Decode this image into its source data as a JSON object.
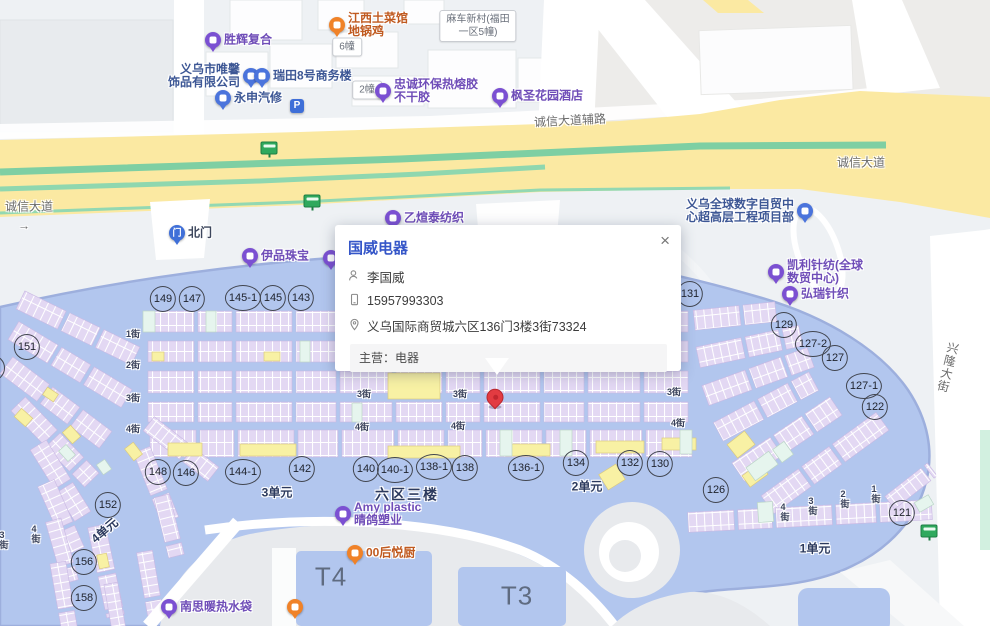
{
  "popup": {
    "title": "国威电器",
    "close": "×",
    "contact_name": "李国威",
    "phone": "15957993303",
    "address": "义乌国际商贸城六区136门3楼3街73324",
    "business_label": "主营：电器"
  },
  "map": {
    "marker": {
      "x": 495,
      "y": 399
    },
    "icons": {
      "gate_glyph": "门",
      "parking_glyph": "P",
      "bus_icon": "bus-stop-sign",
      "person_icon": "person-outline",
      "phone_icon": "mobile-phone-outline",
      "location_icon": "map-pin-outline",
      "close_icon": "x-close"
    },
    "colors": {
      "pin": {
        "purple": "#7b50d2",
        "blue": "#4b74dc",
        "orange": "#f08228",
        "gate": "#3f6fd8"
      },
      "label": {
        "purple": "#6f4db8",
        "blue": "#3d5795",
        "orange": "#c05a20",
        "gate": "#3c465c"
      },
      "red_marker": "#e23b41",
      "complex_blue": "#b2c6ee",
      "stall_purple": "#e3d8f3",
      "stall_yellow": "#f8f1a4",
      "stall_mint": "#e6f5ee",
      "road_yellow": "#fbe9a2",
      "median_green": "#7ecfa3",
      "popup_title": "#3556c8"
    },
    "road_labels": [
      {
        "t": "诚信大道",
        "x": 29,
        "y": 207
      },
      {
        "t": "→",
        "x": 24,
        "y": 226
      },
      {
        "t": "诚信大道",
        "x": 861,
        "y": 163
      },
      {
        "t": "诚信大道辅路",
        "x": 570,
        "y": 121,
        "rot": -3
      },
      {
        "t": "兴隆大街",
        "x": 948,
        "y": 368,
        "v": 1,
        "rot": 14
      }
    ],
    "street_labels": [
      {
        "t": "1街",
        "x": 133,
        "y": 334
      },
      {
        "t": "2街",
        "x": 133,
        "y": 365
      },
      {
        "t": "3街",
        "x": 133,
        "y": 398
      },
      {
        "t": "4街",
        "x": 133,
        "y": 429
      },
      {
        "t": "3街",
        "x": 364,
        "y": 394
      },
      {
        "t": "3街",
        "x": 460,
        "y": 394
      },
      {
        "t": "3街",
        "x": 674,
        "y": 392
      },
      {
        "t": "4街",
        "x": 362,
        "y": 427
      },
      {
        "t": "4街",
        "x": 458,
        "y": 426
      },
      {
        "t": "4街",
        "x": 678,
        "y": 423
      },
      {
        "t": "4街",
        "x": 36,
        "y": 534,
        "v": 1
      },
      {
        "t": "3街",
        "x": 4,
        "y": 540,
        "v": 1
      },
      {
        "t": "4街",
        "x": 785,
        "y": 512,
        "v": 1
      },
      {
        "t": "3街",
        "x": 813,
        "y": 506,
        "v": 1
      },
      {
        "t": "2街",
        "x": 845,
        "y": 499,
        "v": 1
      },
      {
        "t": "1街",
        "x": 876,
        "y": 494,
        "v": 1
      }
    ],
    "unit_labels": [
      {
        "t": "3单元",
        "x": 277,
        "y": 493
      },
      {
        "t": "六区三楼",
        "x": 407,
        "y": 495,
        "big": 1
      },
      {
        "t": "2单元",
        "x": 587,
        "y": 487
      },
      {
        "t": "1单元",
        "x": 815,
        "y": 549
      },
      {
        "t": "4单元",
        "x": 105,
        "y": 531,
        "rot": -40
      }
    ],
    "big_labels": [
      {
        "t": "T4",
        "x": 331,
        "y": 577
      },
      {
        "t": "T3",
        "x": 517,
        "y": 596
      }
    ],
    "boxes": [
      {
        "lines": [
          "6幢"
        ],
        "x": 347,
        "y": 47
      },
      {
        "lines": [
          "2幢"
        ],
        "x": 367,
        "y": 90
      },
      {
        "lines": [
          "麻车新村(福田",
          "一区5幢)"
        ],
        "x": 478,
        "y": 26
      }
    ],
    "circles": [
      {
        "n": "151",
        "x": 27,
        "y": 347
      },
      {
        "n": "-1",
        "x": -8,
        "y": 368
      },
      {
        "n": "149",
        "x": 163,
        "y": 299
      },
      {
        "n": "147",
        "x": 192,
        "y": 299
      },
      {
        "n": "145-1",
        "x": 243,
        "y": 298
      },
      {
        "n": "145",
        "x": 273,
        "y": 298
      },
      {
        "n": "143",
        "x": 301,
        "y": 298
      },
      {
        "n": "131",
        "x": 690,
        "y": 294
      },
      {
        "n": "129",
        "x": 784,
        "y": 325
      },
      {
        "n": "127-2",
        "x": 813,
        "y": 344
      },
      {
        "n": "127",
        "x": 835,
        "y": 358
      },
      {
        "n": "127-1",
        "x": 864,
        "y": 386
      },
      {
        "n": "122",
        "x": 875,
        "y": 407
      },
      {
        "n": "148",
        "x": 158,
        "y": 472
      },
      {
        "n": "146",
        "x": 186,
        "y": 473
      },
      {
        "n": "144-1",
        "x": 243,
        "y": 472
      },
      {
        "n": "142",
        "x": 302,
        "y": 469
      },
      {
        "n": "140",
        "x": 366,
        "y": 469
      },
      {
        "n": "140-1",
        "x": 395,
        "y": 470
      },
      {
        "n": "138-1",
        "x": 434,
        "y": 467
      },
      {
        "n": "138",
        "x": 465,
        "y": 468
      },
      {
        "n": "136-1",
        "x": 526,
        "y": 468
      },
      {
        "n": "134",
        "x": 576,
        "y": 463
      },
      {
        "n": "132",
        "x": 630,
        "y": 463
      },
      {
        "n": "130",
        "x": 660,
        "y": 464
      },
      {
        "n": "126",
        "x": 716,
        "y": 490
      },
      {
        "n": "121",
        "x": 902,
        "y": 513
      },
      {
        "n": "152",
        "x": 108,
        "y": 505
      },
      {
        "n": "156",
        "x": 84,
        "y": 562
      },
      {
        "n": "158",
        "x": 84,
        "y": 598
      }
    ],
    "pois": [
      {
        "t": "purple",
        "x": 213,
        "y": 40,
        "lines": [
          "胜辉复合"
        ],
        "side": "right"
      },
      {
        "t": "orange",
        "x": 337,
        "y": 25,
        "lines": [
          "江西土菜馆",
          "地锅鸡"
        ],
        "side": "right"
      },
      {
        "t": "blue",
        "x": 251,
        "y": 76,
        "lines": [
          "义乌市唯馨",
          "饰品有限公司"
        ],
        "side": "left"
      },
      {
        "t": "blue",
        "x": 262,
        "y": 76,
        "lines": [
          "瑞田8号商务楼"
        ],
        "side": "right"
      },
      {
        "t": "blue",
        "x": 223,
        "y": 98,
        "lines": [
          "永申汽修"
        ],
        "side": "right"
      },
      {
        "t": "purple",
        "x": 383,
        "y": 91,
        "lines": [
          "忠诚环保热熔胶",
          "不干胶"
        ],
        "side": "right"
      },
      {
        "t": "purple",
        "x": 500,
        "y": 96,
        "lines": [
          "枫圣花园酒店"
        ],
        "side": "right"
      },
      {
        "t": "purple",
        "x": 393,
        "y": 218,
        "lines": [
          "乙煊泰纺织"
        ],
        "side": "right"
      },
      {
        "t": "gate",
        "x": 177,
        "y": 233,
        "lines": [
          "北门"
        ],
        "side": "right"
      },
      {
        "t": "purple",
        "x": 250,
        "y": 256,
        "lines": [
          "伊品珠宝"
        ],
        "side": "right"
      },
      {
        "t": "purple",
        "x": 331,
        "y": 258,
        "lines": [],
        "side": "right"
      },
      {
        "t": "blue",
        "x": 805,
        "y": 211,
        "lines": [
          "义乌全球数字自贸中",
          "心超高层工程项目部"
        ],
        "side": "left"
      },
      {
        "t": "purple",
        "x": 776,
        "y": 272,
        "lines": [
          "凯利针纺(全球",
          "数贸中心)"
        ],
        "side": "right"
      },
      {
        "t": "purple",
        "x": 790,
        "y": 294,
        "lines": [
          "弘瑞针织"
        ],
        "side": "right"
      },
      {
        "t": "purple",
        "x": 343,
        "y": 514,
        "lines": [
          "Amy plastic",
          "晴鸽塑业"
        ],
        "side": "right"
      },
      {
        "t": "orange",
        "x": 355,
        "y": 553,
        "lines": [
          "00后悦厨"
        ],
        "side": "right"
      },
      {
        "t": "purple",
        "x": 169,
        "y": 607,
        "lines": [
          "南思暖热水袋"
        ],
        "side": "right"
      },
      {
        "t": "orange",
        "x": 295,
        "y": 607,
        "lines": [],
        "side": "right"
      }
    ],
    "bus_stops": [
      {
        "x": 269,
        "y": 148
      },
      {
        "x": 312,
        "y": 201
      },
      {
        "x": 929,
        "y": 531
      }
    ],
    "parking": [
      {
        "x": 297,
        "y": 106
      }
    ]
  }
}
